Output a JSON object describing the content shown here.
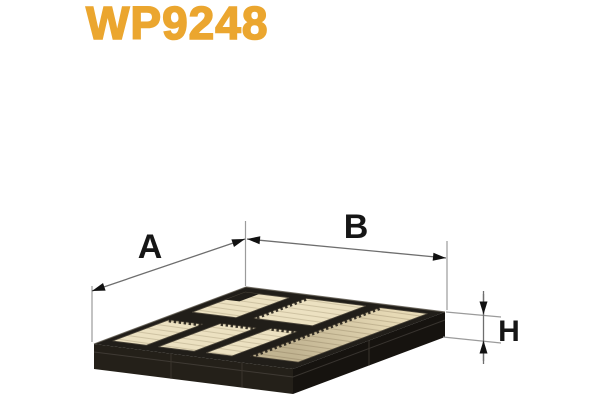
{
  "header": {
    "part_number": "WP9248"
  },
  "diagram": {
    "description": "cabin-air-filter-3d-technical-drawing",
    "labels": {
      "a": "A",
      "b": "B",
      "h": "H"
    }
  },
  "colors": {
    "bg": "#ffffff",
    "amber": "#EBA62F",
    "media": "#ECE1C1",
    "media2": "#E7DAB6",
    "frame": "#211E19",
    "dimline": "#6E6E6E",
    "extline": "#9B9B9B",
    "label": "#161616",
    "arrow": "#111111"
  }
}
